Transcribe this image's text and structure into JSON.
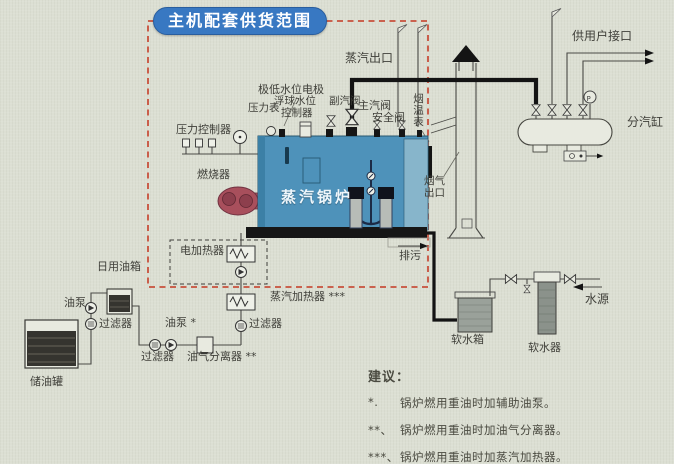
{
  "title": "主机配套供货范围",
  "boiler": {
    "name": "蒸汽锅炉"
  },
  "labels": {
    "steam_outlet": "蒸汽出口",
    "user_interface": "供用户接口",
    "steam_cylinder": "分汽缸",
    "low_water_electrode": "极低水位电极",
    "pressure_gauge": "压力表",
    "float_controller_line1": "浮球水位",
    "float_controller_line2": "控制器",
    "aux_steam_valve": "副汽阀",
    "main_steam_valve": "主汽阀",
    "safety_valve": "安全阀",
    "flue_temp_gauge": "烟温表",
    "pressure_controller": "压力控制器",
    "burner": "燃烧器",
    "flue_gas_outlet": "烟气出口",
    "blowdown": "排污",
    "electric_heater": "电加热器",
    "steam_heater": "蒸汽加热器 ***",
    "daily_oil_tank": "日用油箱",
    "oil_pump_1": "油泵",
    "filter_1": "过滤器",
    "storage_tank": "储油罐",
    "filter_2": "过滤器",
    "oil_pump_2": "油泵 *",
    "oil_gas_separator": "油气分离器 **",
    "filter_3": "过滤器",
    "soft_water_tank": "软水箱",
    "water_softener": "软水器",
    "water_source": "水源",
    "gauge_letter": "P"
  },
  "notes": {
    "heading": "建议：",
    "items": [
      {
        "marker": "*.",
        "text": "锅炉燃用重油时加辅助油泵。"
      },
      {
        "marker": "**、",
        "text": "锅炉燃用重油时加油气分离器。"
      },
      {
        "marker": "***、",
        "text": "锅炉燃用重油时加蒸汽加热器。"
      }
    ]
  },
  "colors": {
    "background": "#dcdfd3",
    "title_pill": "#3878c2",
    "supply_border": "#c8503c",
    "boiler_body": "#4e92ba",
    "burner": "#a84f5c",
    "oil_dark": "#35342f",
    "soft_water_tank": "#9aa19a",
    "pipe": "#4a4a46"
  }
}
